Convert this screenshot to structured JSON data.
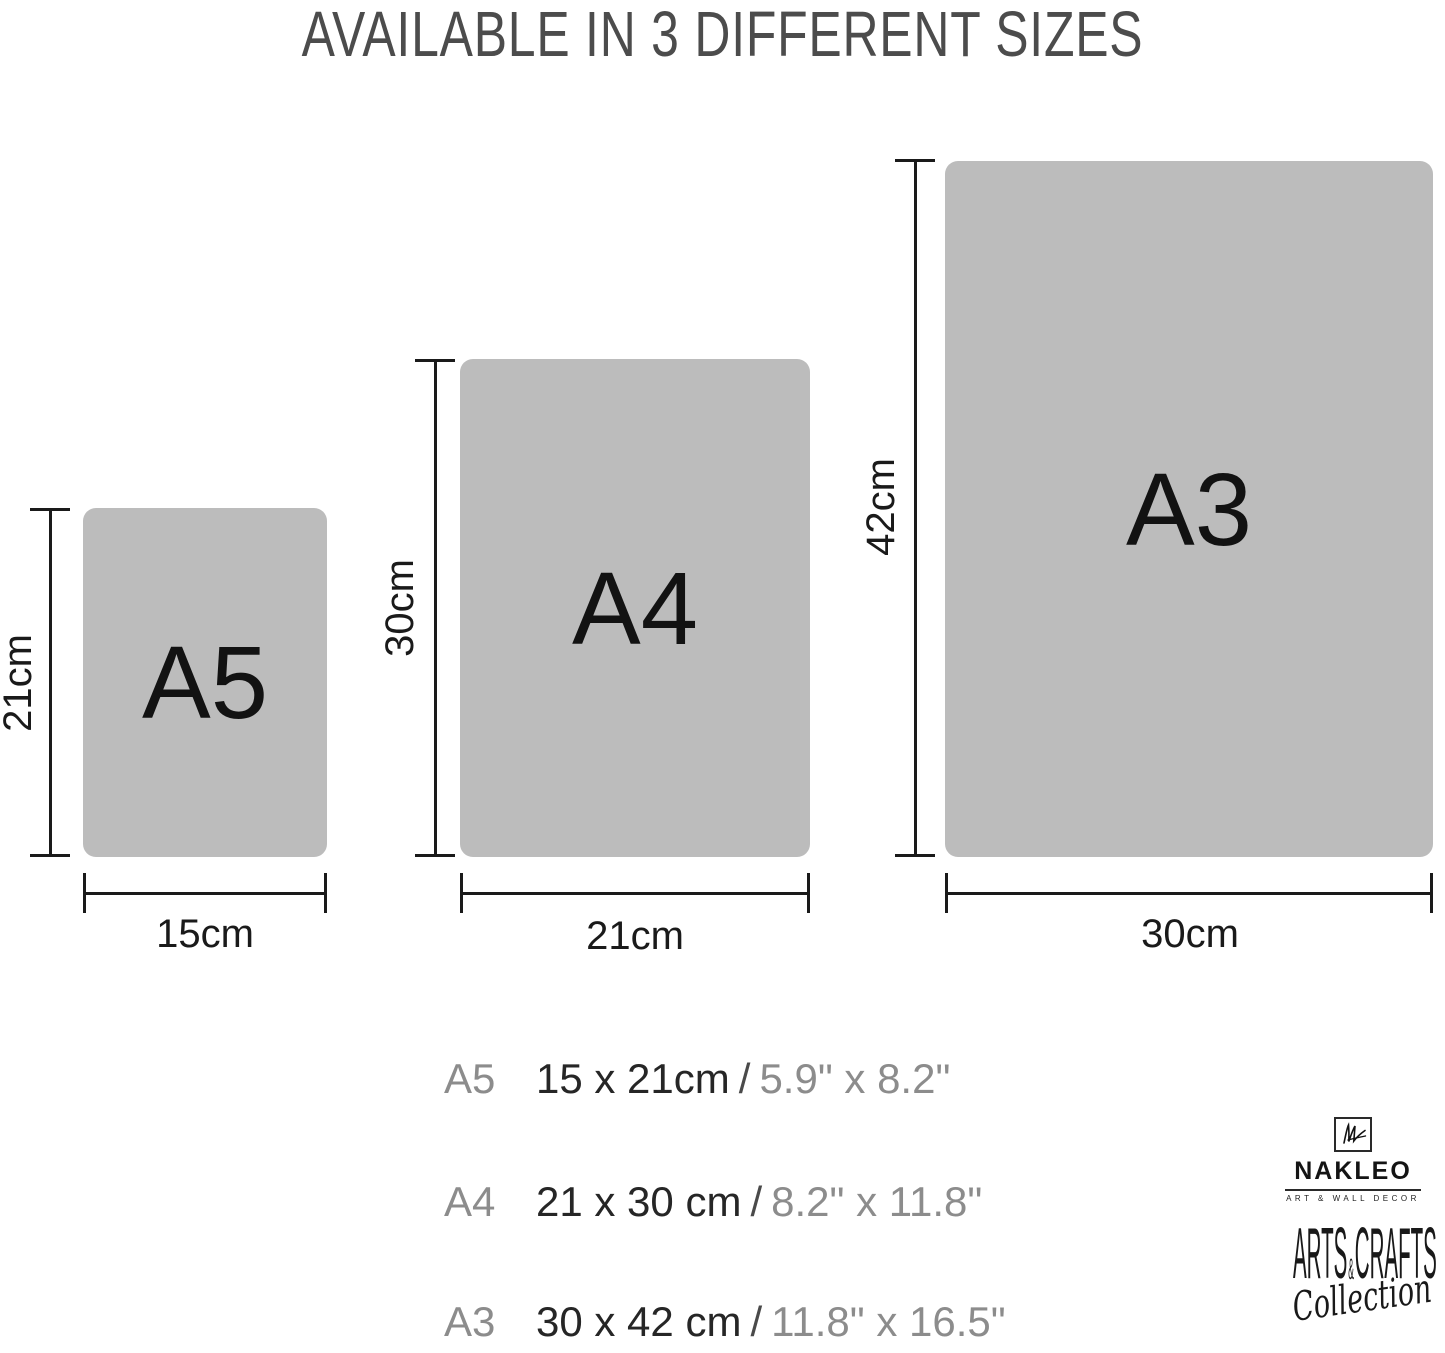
{
  "title": "AVAILABLE IN 3 DIFFERENT SIZES",
  "colors": {
    "background": "#ffffff",
    "paper_fill": "#bcbcbc",
    "title_text": "#4c4c4c",
    "dimension_lines": "#1a1a1a",
    "legend_muted": "#8c8c8c",
    "legend_dark": "#262626",
    "brand_ink": "#141414"
  },
  "sizes": [
    {
      "code": "A5",
      "box_label": "A5",
      "height_dim": "21cm",
      "width_dim": "15cm"
    },
    {
      "code": "A4",
      "box_label": "A4",
      "height_dim": "30cm",
      "width_dim": "21cm"
    },
    {
      "code": "A3",
      "box_label": "A3",
      "height_dim": "42cm",
      "width_dim": "30cm"
    }
  ],
  "legend": [
    {
      "code": "A5",
      "metric": "15 x 21cm",
      "separator": "/",
      "imperial": "5.9\" x 8.2\""
    },
    {
      "code": "A4",
      "metric": "21 x 30 cm",
      "separator": "/",
      "imperial": "8.2\" x 11.8\""
    },
    {
      "code": "A3",
      "metric": "30 x 42 cm",
      "separator": "/",
      "imperial": "11.8\" x 16.5\""
    }
  ],
  "brand": {
    "monogram": "NL",
    "name": "NAKLEO",
    "tagline": "ART & WALL DECOR",
    "collection_word1": "ARTS",
    "collection_amp": "&",
    "collection_word2": "CRAFTS",
    "collection_script": "Collection"
  }
}
